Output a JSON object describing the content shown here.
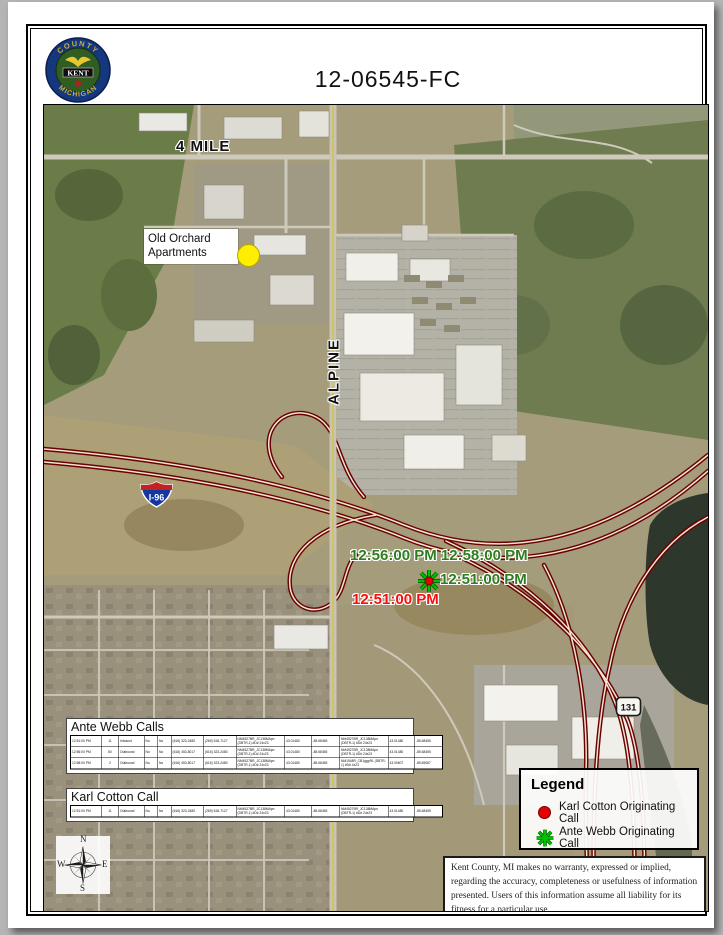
{
  "doc": {
    "title": "12-06545-FC",
    "seal": {
      "top_text": "COUNTY",
      "center_text": "KENT",
      "bottom_text": "MICHIGAN"
    }
  },
  "map": {
    "labels": {
      "four_mile": "4 MILE",
      "old_orchard_line1": "Old Orchard",
      "old_orchard_line2": "Apartments",
      "alpine": "ALPINE",
      "i96": "I-96",
      "us131": "131"
    },
    "time_labels": {
      "green_a": "12:56:00 PM",
      "green_b": "12:58:00 PM",
      "green_c": "12:51:00 PM",
      "red_a": "12:51:00 PM"
    }
  },
  "tables": {
    "ante_webb": {
      "title": "Ante Webb Calls",
      "rows": [
        [
          "12:51:00 PM",
          "11",
          "Inbound",
          "No",
          "No",
          "(616) 323-2480",
          "(269) 518-7127",
          "NM4527BR_JC138MApn (DBTR-1) #D# 24x23",
          "43.01480",
          "-85.68455",
          "NM4527BR_JC138MApn (DBTR-1) #D# 24x23",
          "43.01480",
          "-85.68455"
        ],
        [
          "12:56:00 PM",
          "60",
          "Outbound",
          "No",
          "No",
          "(616) 453-8017",
          "(616) 323-2480",
          "NM4527BR_JC138MApn (DBTR-1) #D# 24x23",
          "43.01480",
          "-85.68455",
          "NM4527BR_JC138MApn (DBTR-1) #D# 24x23",
          "43.01480",
          "-85.68455"
        ],
        [
          "12:58:00 PM",
          "2",
          "Outbound",
          "No",
          "No",
          "(616) 453-8017",
          "(616) 323-2480",
          "NM4527BR_JC138MApn (DBTR-1) #D# 24x23",
          "43.01480",
          "-85.68455",
          "NM1548R_CB1ggpRL (DBTR-1) #D# 4x23",
          "43.00607",
          "-85.69087"
        ]
      ]
    },
    "karl_cotton": {
      "title": "Karl Cotton Call",
      "rows": [
        [
          "12:51:00 PM",
          "11",
          "Outbound",
          "No",
          "No",
          "(616) 323-2480",
          "(269) 518-7127",
          "NM4527BR_JC138MApn (DBTR-1) #D# 24x23",
          "43.01480",
          "-85.68455",
          "NM4527BR_JC138MApn (DBTR-1) #D# 24x23",
          "43.01480",
          "-85.68455"
        ]
      ]
    }
  },
  "legend": {
    "title": "Legend",
    "items": [
      {
        "icon": "red-circle",
        "label": "Karl Cotton Originating Call"
      },
      {
        "icon": "green-star",
        "label": "Ante Webb Originating Call"
      }
    ]
  },
  "compass": {
    "n": "N",
    "e": "E",
    "s": "S",
    "w": "W"
  },
  "disclaimer": "Kent County, MI makes no warranty, expressed or implied, regarding the accuracy, completeness or usefulness of information presented.  Users of this information assume all liability for its fitness for a particular use.",
  "colors": {
    "highway_red": "#6b0000",
    "green_label": "#2e7d1e",
    "red_label": "#fb0d0d",
    "marker_green": "#00c000",
    "marker_red": "#e60000",
    "yellow_dot": "#ffee00"
  }
}
